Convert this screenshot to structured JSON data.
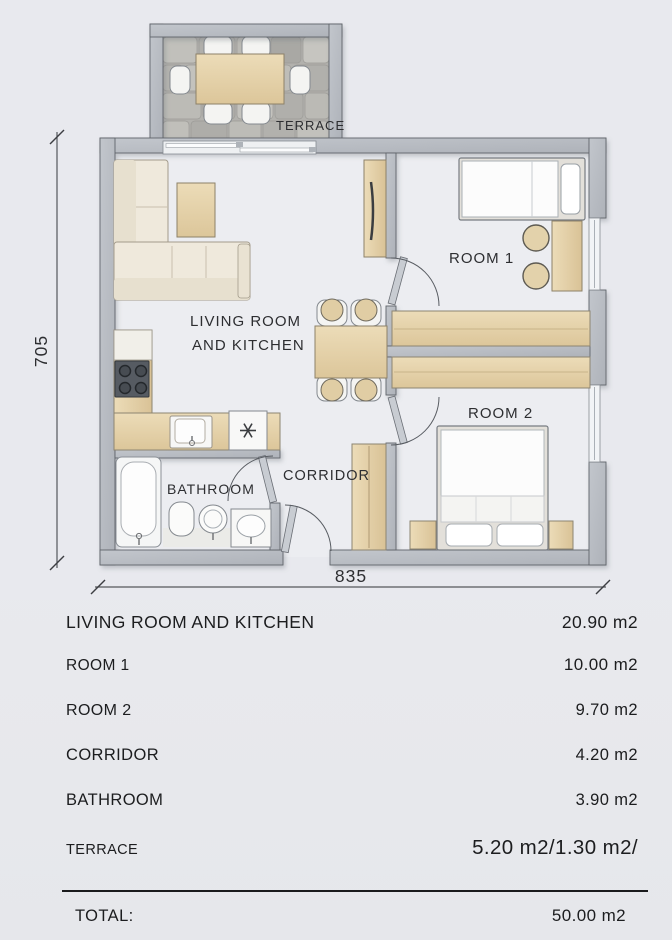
{
  "plan": {
    "labels": {
      "terrace": "TERRACE",
      "living_room_line1": "LIVING ROOM",
      "living_room_line2": "AND KITCHEN",
      "room1": "ROOM 1",
      "room2": "ROOM 2",
      "corridor": "CORRIDOR",
      "bathroom": "BATHROOM"
    },
    "dimensions": {
      "height_label": "705",
      "width_label": "835"
    }
  },
  "legend": {
    "rows": [
      {
        "label": "LIVING ROOM AND KITCHEN",
        "area": "20.90 m2"
      },
      {
        "label": "ROOM 1",
        "area": "10.00 m2"
      },
      {
        "label": "ROOM 2",
        "area": "9.70 m2"
      },
      {
        "label": "CORRIDOR",
        "area": "4.20 m2"
      },
      {
        "label": "BATHROOM",
        "area": "3.90 m2"
      },
      {
        "label": "TERRACE",
        "area": "5.20 m2/1.30 m2/"
      }
    ],
    "total": {
      "label": "TOTAL:",
      "area": "50.00 m2"
    }
  },
  "colors": {
    "wall": "#b7bbc2",
    "wood": "#e5d1a8",
    "upholstery": "#efe9dc",
    "background": "#e8e9ed",
    "text": "#222326"
  }
}
